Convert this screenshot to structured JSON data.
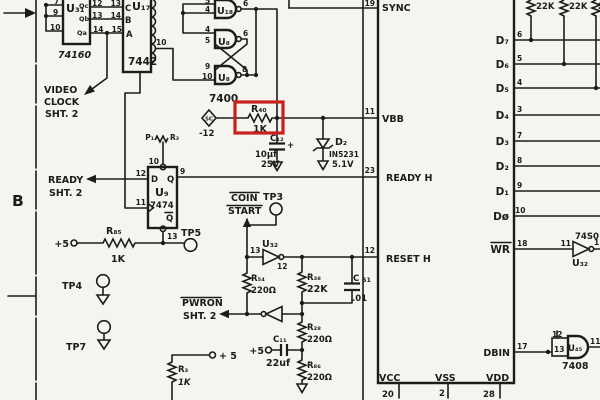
{
  "highlight": {
    "color": "#c8201d"
  },
  "zone": {
    "b": "B"
  },
  "u31": {
    "ref": "U₃₁",
    "part": "74160",
    "q1": "Qc",
    "q2": "Qb",
    "q3": "Qa",
    "in1": "7",
    "in2": "9",
    "in3": "10",
    "out1": "12",
    "out2": "13",
    "out3": "14"
  },
  "u17": {
    "ref": "U₁₇",
    "part": "7442",
    "in1": "C",
    "in2": "B",
    "in3": "A",
    "pin1": "13",
    "pin2": "14",
    "pin3": "15",
    "pin10": "10"
  },
  "latch": {
    "part": "7400",
    "u18": {
      "ref": "U₁₈",
      "in1": "5",
      "in2": "4",
      "out": "6"
    },
    "u8a": {
      "ref": "U₈",
      "in1": "4",
      "in2": "5",
      "out": "6"
    },
    "u8b": {
      "ref": "U₈",
      "in1": "9",
      "in2": "10",
      "out": "8"
    }
  },
  "video": {
    "l1": "VIDEO",
    "l2": "CLOCK",
    "l3": "SHT. 2"
  },
  "vbb_net": {
    "source": "5C",
    "source_val": "-12",
    "r40_ref": "R₄₀",
    "r40_val": "1K",
    "c12_ref": "C₁₂",
    "c12_val": "10μf",
    "c12_volt": "25V",
    "c12_plus": "+",
    "d2_ref": "D₂",
    "d2_part": "IN5231",
    "d2_volt": "5.1V"
  },
  "u9": {
    "ref": "U₉",
    "part": "7474",
    "d": "D",
    "q": "Q",
    "qbar": "Q",
    "pin10": "10",
    "pin12": "12",
    "pin11": "11",
    "pin9": "9",
    "pin13": "13",
    "preset_p": "P₁",
    "preset_r": "R₃"
  },
  "ready_out": {
    "l1": "READY",
    "l2": "SHT. 2"
  },
  "r85": {
    "ref": "R₈₅",
    "val": "1K",
    "plus": "+5"
  },
  "tp": {
    "tp3": "TP3",
    "tp4": "TP4",
    "tp5": "TP5",
    "tp7": "TP7"
  },
  "coin": {
    "l1": "COIN",
    "l2": "START"
  },
  "u32_coin": {
    "ref": "U₃₂",
    "pin_in": "13",
    "pin_out": "12"
  },
  "pwron": {
    "l1": "PWRON",
    "l2": "SHT. 2"
  },
  "rc": {
    "r54_ref": "R₅₄",
    "r54_val": "220Ω",
    "r38_ref": "R₃₈",
    "r38_val": "22K",
    "r28_ref": "R₂₈",
    "r28_val": "220Ω",
    "r86_ref": "R₈₆",
    "r86_val": "220Ω",
    "c51_ref": "C",
    "c51_num": "51",
    "c51_val": ".01",
    "c11_ref": "C₁₁",
    "c11_val": "22uf",
    "c11_plus": "+5",
    "r3_ref": "R₃",
    "r3_val": "1K",
    "r3_plus": "+ 5"
  },
  "cpu": {
    "sync": "SYNC",
    "sync_pin": "19",
    "vbb": "VBB",
    "vbb_pin": "11",
    "ready": "READY H",
    "ready_pin": "23",
    "reset": "RESET H",
    "reset_pin": "12",
    "dbin": "DBIN",
    "dbin_pin": "17",
    "wr": "WR",
    "wr_pin": "18",
    "vcc": "VCC",
    "vcc_pin": "20",
    "vss": "VSS",
    "vss_pin": "2",
    "vdd": "VDD",
    "vdd_pin": "28",
    "data": [
      {
        "label": "D₇",
        "pin": "6"
      },
      {
        "label": "D₆",
        "pin": "5"
      },
      {
        "label": "D₅",
        "pin": "4"
      },
      {
        "label": "D₄",
        "pin": "3"
      },
      {
        "label": "D₃",
        "pin": "7"
      },
      {
        "label": "D₂",
        "pin": "8"
      },
      {
        "label": "D₁",
        "pin": "9"
      },
      {
        "label": "Dø",
        "pin": "10"
      }
    ]
  },
  "pullups": {
    "r1": "22K",
    "r2": "22K",
    "r3": "22K"
  },
  "u32_wr": {
    "ref": "U₃₂",
    "part": "74S0",
    "pin_in": "11",
    "pin_out": "1"
  },
  "u45": {
    "ref": "U₄₅",
    "part": "7408",
    "pin_a": "12",
    "pin_b": "13",
    "pin_out": "11"
  }
}
